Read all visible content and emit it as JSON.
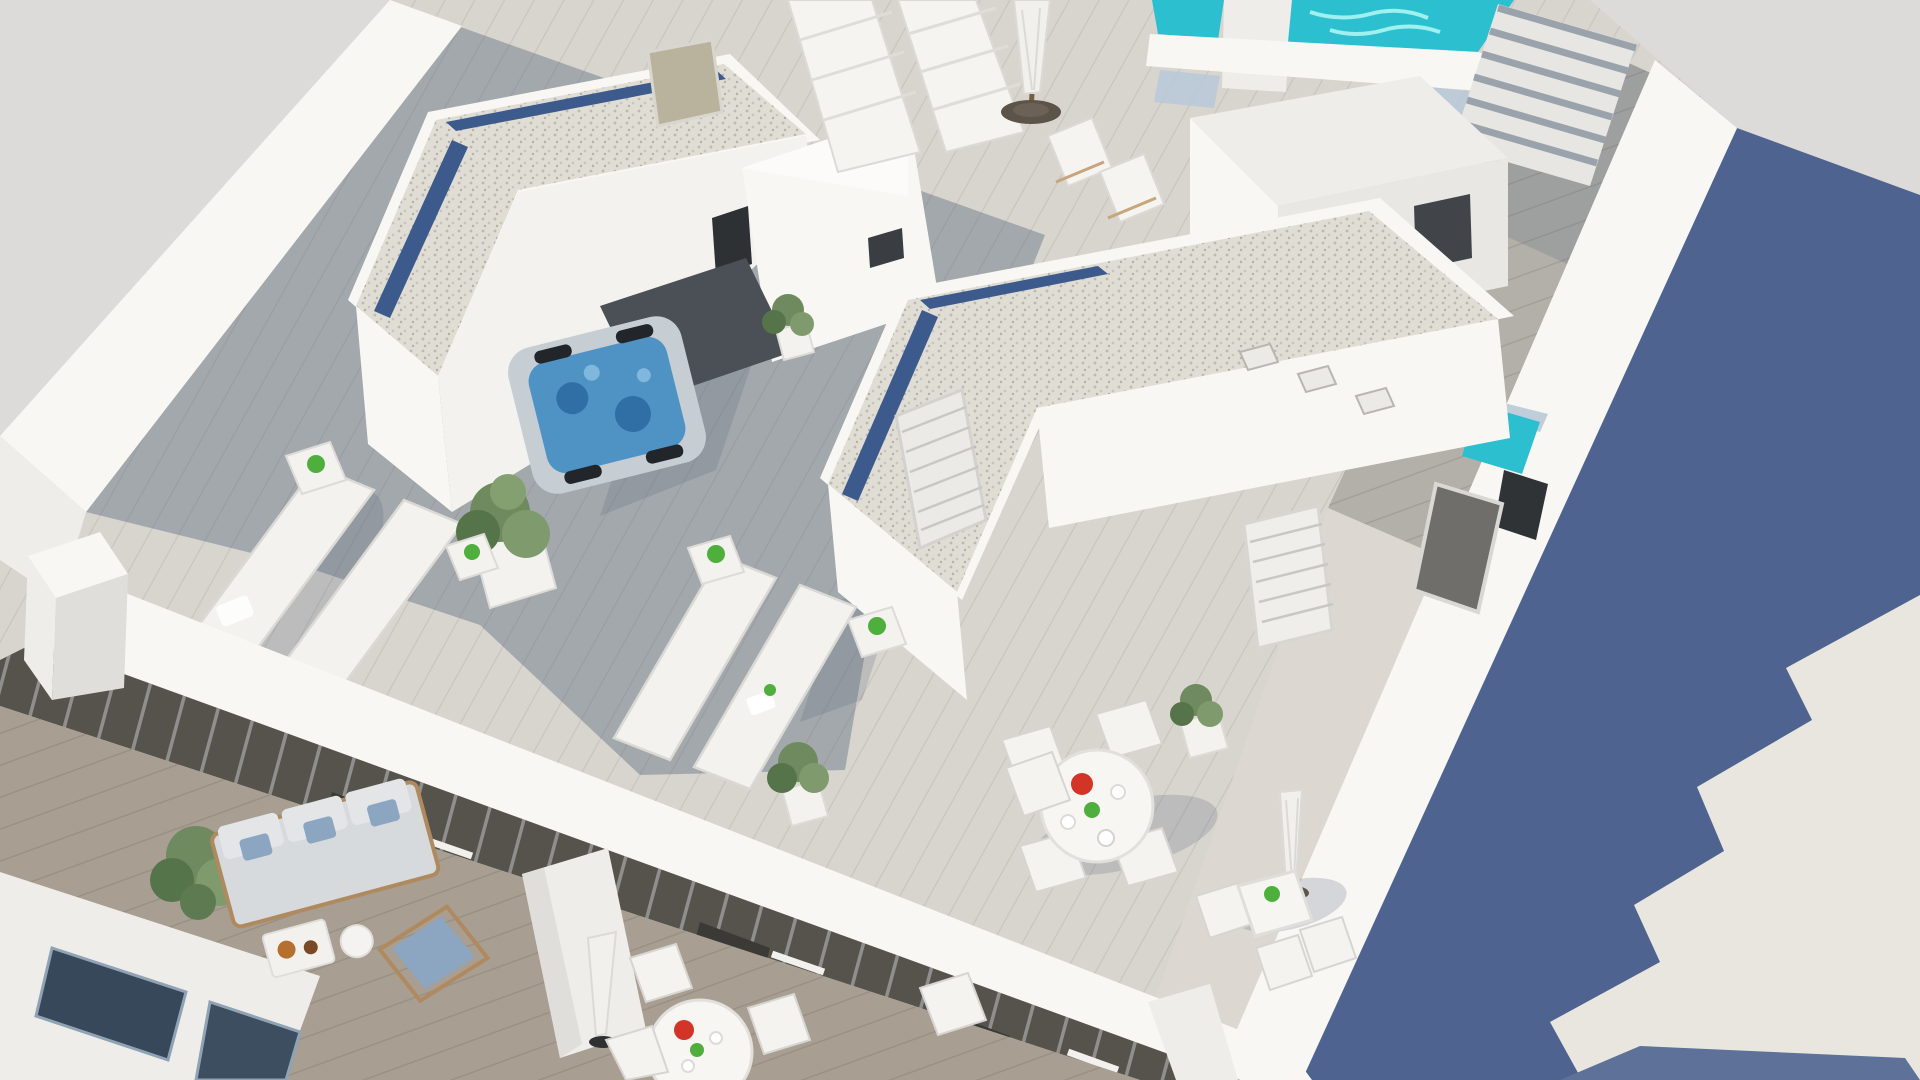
{
  "scene": {
    "title": "Aerial 3D rendering of modern white apartment building rooftop terraces",
    "type": "architectural-visualization"
  },
  "palette": {
    "background": "#dcdbd9",
    "blue_wall": "#4e638f",
    "shadow_blue": "#5e7199",
    "ground_light": "#e9e6e0",
    "roof_deck": "#d8d5ce",
    "building_white": "#efede9",
    "parapet_white": "#f8f7f4",
    "gravel": "#e0ddd5",
    "blue_glass": "#3c5a8c",
    "pool_water": "#2bbfd0",
    "jacuzzi_water": "#4f93c4",
    "jacuzzi_shell": "#c6ced4",
    "plant_green": "#6f8a5e",
    "plant_dark": "#56744a",
    "facade_dark": "#56534c",
    "wood_balcony": "#a89e91",
    "red_accent": "#d23428",
    "green_accent": "#4faf3c",
    "umbrella_base": "#5c5349",
    "glass_blue": "#b9c8d8",
    "stairs_shade": "#9aa2ac",
    "door_tan": "#b9b29c",
    "door_gray": "#6f6e6a",
    "sofa_gray": "#d7dadd",
    "pillow_blue": "#8ca6c2",
    "fruit_orange": "#b5702f"
  },
  "objects": [
    {
      "name": "plunge-pool",
      "label": "Rooftop plunge pool"
    },
    {
      "name": "rooftop-stairs",
      "label": "Access stairs"
    },
    {
      "name": "gravel-roof-1",
      "label": "Gravel roof with blue glass strip"
    },
    {
      "name": "gravel-roof-2",
      "label": "Gravel roof with blue glass strip"
    },
    {
      "name": "jacuzzi",
      "label": "Hot tub"
    },
    {
      "name": "sun-loungers",
      "label": "Sun loungers"
    },
    {
      "name": "dining-set",
      "label": "Round outdoor dining set"
    },
    {
      "name": "bistro-set",
      "label": "Bistro table with parasol"
    },
    {
      "name": "balcony-sofa-set",
      "label": "Balcony sofa set"
    },
    {
      "name": "balcony-table-set",
      "label": "Balcony round table set"
    },
    {
      "name": "potted-plants",
      "label": "Potted plants"
    },
    {
      "name": "wood-walkway",
      "label": "Wood deck walkway"
    }
  ]
}
